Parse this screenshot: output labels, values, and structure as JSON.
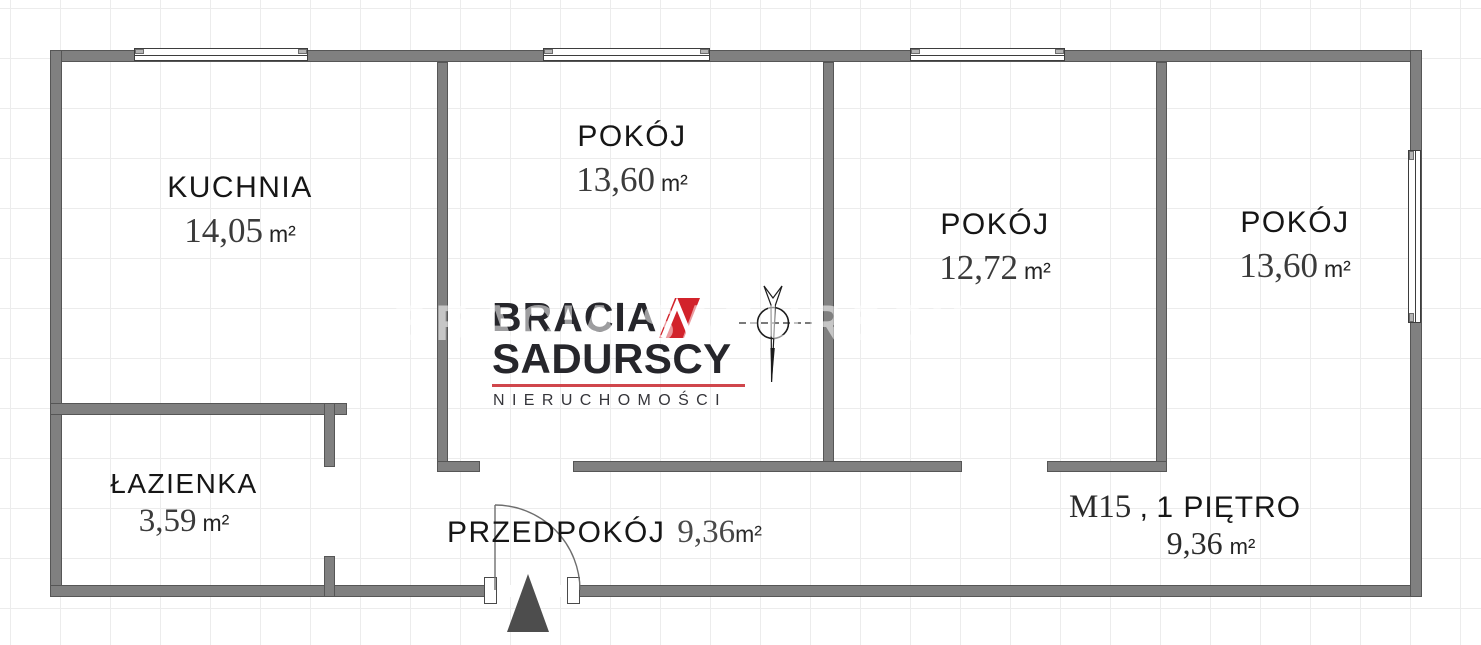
{
  "watermark": {
    "text": "BRACIA SADURSCY"
  },
  "logo": {
    "line1": "BRACIA",
    "line2": "SADURSCY",
    "line3": "NIERUCHOMOŚCI"
  },
  "rooms": {
    "kuchnia": {
      "name": "KUCHNIA",
      "area": "14,05",
      "unit": "m²"
    },
    "pokoj1": {
      "name": "POKÓJ",
      "area": "13,60",
      "unit": "m²"
    },
    "pokoj2": {
      "name": "POKÓJ",
      "area": "12,72",
      "unit": "m²"
    },
    "pokoj3": {
      "name": "POKÓJ",
      "area": "13,60",
      "unit": "m²"
    },
    "lazienka": {
      "name": "ŁAZIENKA",
      "area": "3,59",
      "unit": "m²"
    },
    "przedpokoj": {
      "name": "PRZEDPOKÓJ",
      "area": "9,36",
      "unit": "m²"
    }
  },
  "apartment": {
    "id": "M15",
    "separator": " , ",
    "floor": "1 PIĘTRO",
    "area": "9,36",
    "unit": "m²"
  },
  "colors": {
    "wall": "#808080",
    "brand_red": "#d2232b",
    "underline_red": "#d0464c"
  },
  "icons": {
    "north_arrow": "north-arrow-icon",
    "door_swing": "door-swing-icon",
    "entrance": "entrance-triangle-icon"
  }
}
